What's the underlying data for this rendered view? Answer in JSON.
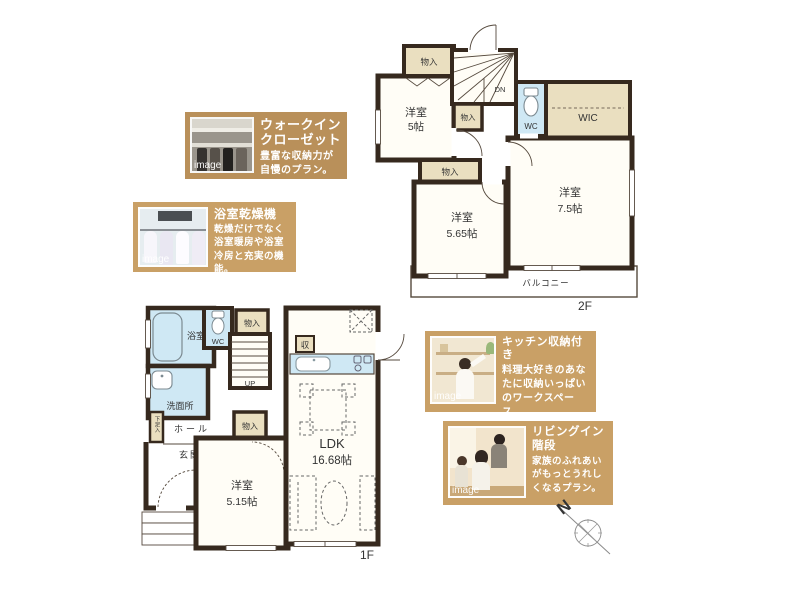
{
  "plan_2f": {
    "floor_label": "2F",
    "stair_label": "DN",
    "rooms": {
      "closet_top": "物入",
      "closet_mid": "物入",
      "closet_low": "物入",
      "bedroom_a_name": "洋室",
      "bedroom_a_size": "5帖",
      "wc": "WC",
      "wic": "WIC",
      "bedroom_b_name": "洋室",
      "bedroom_b_size": "7.5帖",
      "bedroom_c_name": "洋室",
      "bedroom_c_size": "5.65帖",
      "balcony": "バルコニー"
    }
  },
  "plan_1f": {
    "floor_label": "1F",
    "stair_label": "UP",
    "rooms": {
      "bath": "浴室",
      "wc": "WC",
      "closet_top": "物入",
      "washroom": "洗面所",
      "shoe_cabinet": "下足入",
      "hall": "ホール",
      "entrance": "玄関",
      "closet_mid": "物入",
      "bedroom_name": "洋室",
      "bedroom_size": "5.15帖",
      "ldk_name": "LDK",
      "ldk_size": "16.68帖",
      "kitchen_storage": "収"
    }
  },
  "features": [
    {
      "title": "ウォークインクローゼット",
      "desc": "豊富な収納力が自慢のプラン。",
      "image_label": "image"
    },
    {
      "title": "浴室乾燥機",
      "desc": "乾燥だけでなく浴室暖房や浴室冷房と充実の機能。",
      "image_label": "image"
    },
    {
      "title": "キッチン収納付き",
      "desc": "料理大好きのあなたに収納いっぱいのワークスペース。",
      "image_label": "image"
    },
    {
      "title": "リビングイン階段",
      "desc": "家族のふれあいがもっとうれしくなるプラン。",
      "image_label": "image"
    }
  ],
  "compass": {
    "north_label": "N"
  },
  "colors": {
    "wall": "#36291e",
    "water_room": "#cfe8f4",
    "storage": "#eadfc0",
    "feature_box_dark": "#b9905a",
    "feature_box_light": "#c9a066"
  }
}
